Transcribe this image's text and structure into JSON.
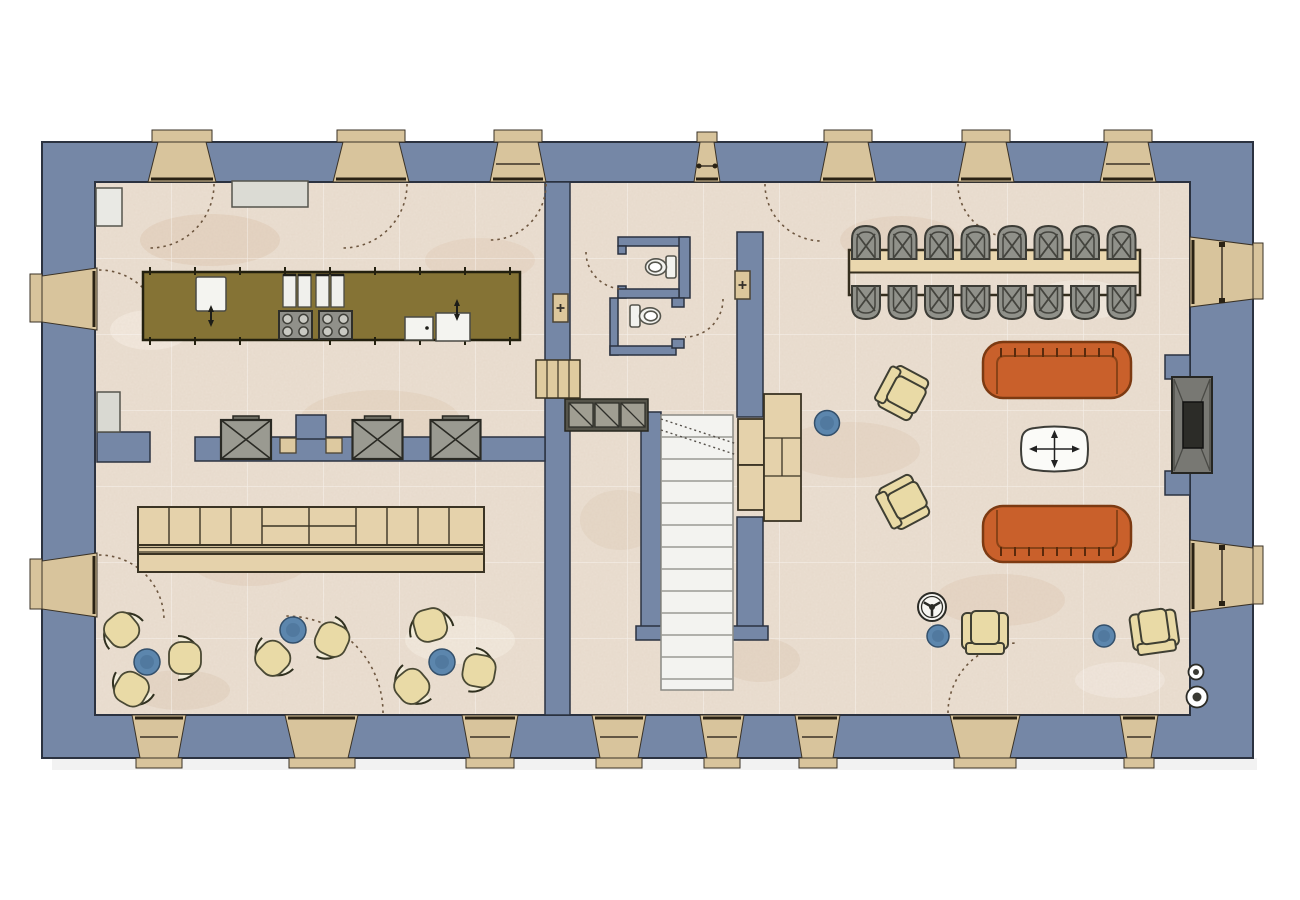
{
  "colors": {
    "background": "#ffffff",
    "wall": "#7587a6",
    "wall_outline": "#2b3240",
    "floor": "#ebdfd2",
    "floor_grid": "#ffffff",
    "window_wood": "#d8c49c",
    "sill_wood": "#cdb88c",
    "lintel": "#2a2214",
    "door_arc": "#6d563f",
    "island": "#857335",
    "island_outline": "#23200f",
    "appliance_gray": "#95958d",
    "fixture_white": "#f4f4f0",
    "wood_light": "#e5d2ab",
    "wood_outline": "#3b3424",
    "sofa_orange": "#c9602b",
    "sofa_outline": "#7c3a12",
    "chair_beige": "#e9daa6",
    "rattan_gray": "#90918a",
    "stool_blue": "#5c86ad",
    "stair_tread": "#f3f3f0",
    "hatch_gray": "#a09e92",
    "fireplace_gray": "#787873",
    "firebox_dark": "#2c2c28",
    "radiator_beige": "#dcc79c"
  },
  "inventory": {
    "dining_chairs": 16,
    "dining_tables": 1,
    "sofas": 2,
    "lounge_tub_chairs": 8,
    "armchairs": 4,
    "blue_side_stools": 6,
    "coffee_tables": 1,
    "toilets": 2,
    "cooktops": 2,
    "burners_per_cooktop": 4,
    "kitchen_sinks": 3,
    "wall_equipment_boxes": 3,
    "radiators": 2,
    "speaker_symbols": 2,
    "fireplaces": 1,
    "staircases": 1,
    "window_and_door_openings": 19
  },
  "rooms": [
    {
      "name": "kitchen",
      "position": "top-left"
    },
    {
      "name": "lounge-bar",
      "position": "bottom-left"
    },
    {
      "name": "wc-hallway",
      "position": "center-top"
    },
    {
      "name": "stair-hall",
      "position": "center-bottom"
    },
    {
      "name": "living-dining-room",
      "position": "right"
    }
  ]
}
